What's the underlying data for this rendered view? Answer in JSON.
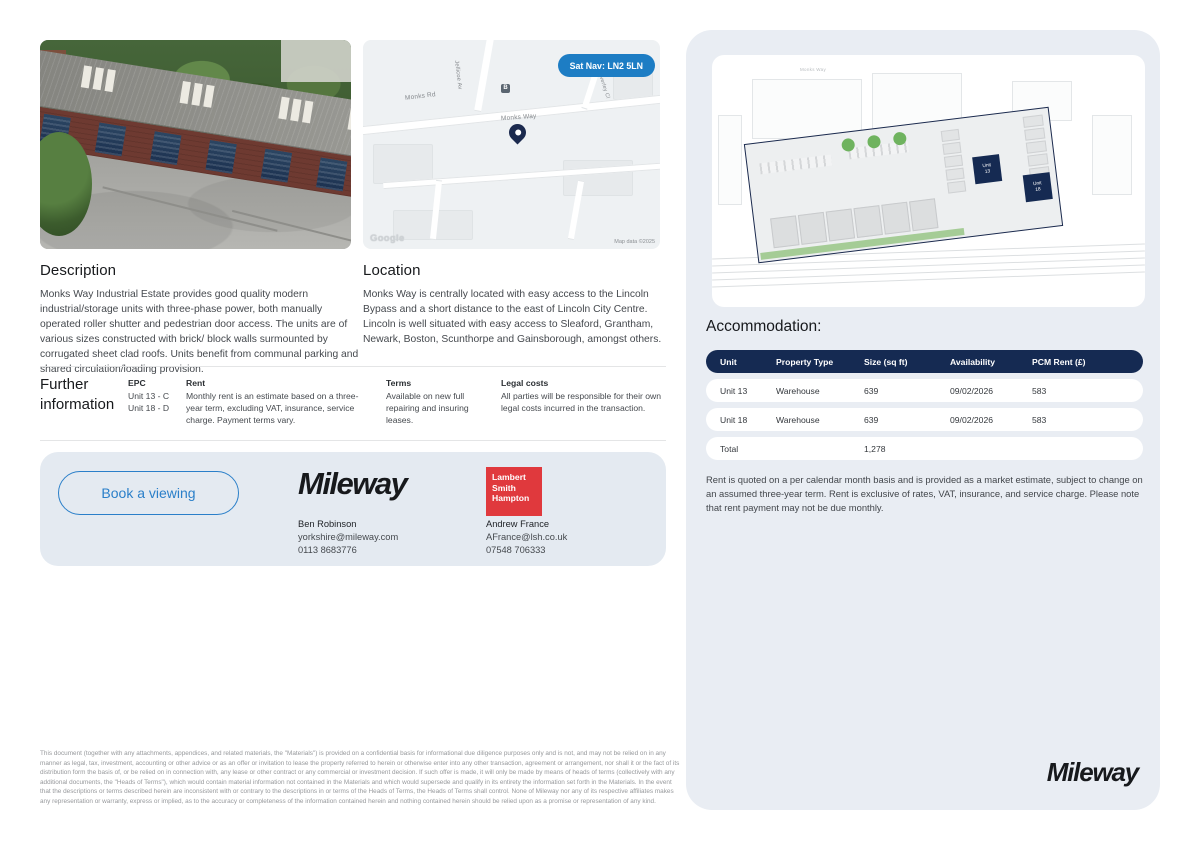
{
  "map": {
    "sat_nav": "Sat Nav: LN2 5LN",
    "roads": {
      "monks_rd": "Monks Rd",
      "monks_way": "Monks Way",
      "jellicoe": "Jellicoe Av",
      "side_close": "Waverley Cl"
    },
    "google": "Google",
    "attribution": "Map data ©2025"
  },
  "description": {
    "title": "Description",
    "body": "Monks Way Industrial Estate provides good quality modern industrial/storage units with three-phase power, both manually operated roller shutter and pedestrian door access. The units are of various sizes constructed with brick/ block walls surmounted by corrugated sheet clad roofs. Units benefit from communal parking and shared circulation/loading provision."
  },
  "location": {
    "title": "Location",
    "body": "Monks Way is centrally located with easy access to the Lincoln Bypass and a short distance to the east of Lincoln City Centre. Lincoln is well situated with easy access to Sleaford, Grantham, Newark, Boston, Scunthorpe and Gainsborough, amongst others."
  },
  "further_information": {
    "title_line1": "Further",
    "title_line2": "information",
    "epc": {
      "heading": "EPC",
      "lines": [
        "Unit 13 - C",
        "Unit 18 - D"
      ]
    },
    "rent": {
      "heading": "Rent",
      "body": "Monthly rent is an estimate based on a three-year term, excluding VAT, insurance, service charge. Payment terms vary."
    },
    "terms": {
      "heading": "Terms",
      "body": "Available on new full repairing and insuring leases."
    },
    "legal": {
      "heading": "Legal costs",
      "body": "All parties will be responsible for their own legal costs incurred in the transaction."
    }
  },
  "contact": {
    "book_button": "Book a viewing",
    "mileway_logo": "Mileway",
    "agent1": {
      "name": "Ben Robinson",
      "email": "yorkshire@mileway.com",
      "phone": "0113 8683776"
    },
    "lsh_logo": [
      "Lambert",
      "Smith",
      "Hampton"
    ],
    "agent2": {
      "name": "Andrew France",
      "email": "AFrance@lsh.co.uk",
      "phone": "07548 706333"
    }
  },
  "siteplan": {
    "road_label": "Monks Way",
    "unit13": {
      "l1": "Unit",
      "l2": "13"
    },
    "unit18": {
      "l1": "Unit",
      "l2": "18"
    }
  },
  "accommodation": {
    "title": "Accommodation:",
    "headers": [
      "Unit",
      "Property Type",
      "Size (sq ft)",
      "Availability",
      "PCM Rent (£)"
    ],
    "rows": [
      [
        "Unit 13",
        "Warehouse",
        "639",
        "09/02/2026",
        "583"
      ],
      [
        "Unit 18",
        "Warehouse",
        "639",
        "09/02/2026",
        "583"
      ],
      [
        "Total",
        "",
        "1,278",
        "",
        ""
      ]
    ],
    "note": "Rent is quoted on a per calendar month basis and is provided as a market estimate, subject to change on an assumed three-year term. Rent is exclusive of rates, VAT, insurance, and service charge. Please note that rent payment may not be due monthly."
  },
  "branding": {
    "mileway_bottom": "Mileway"
  },
  "footer": {
    "disclaimer": "This document (together with any attachments, appendices, and related materials, the \"Materials\") is provided on a confidential basis for informational due diligence purposes only and is not, and may not be relied on in any manner as legal, tax, investment, accounting or other advice or as an offer or invitation to lease the property referred to herein or otherwise enter into any other transaction, agreement or arrangement, nor shall it or the fact of its distribution form the basis of, or be relied on in connection with, any lease or other contract or any commercial or investment decision. If such offer is made, it will only be made by means of heads of terms (collectively with any additional documents, the \"Heads of Terms\"), which would contain material information not contained in the Materials and which would supersede and qualify in its entirety the information set forth in the Materials. In the event that the descriptions or terms described herein are inconsistent with or contrary to the descriptions in or terms of the Heads of Terms, the Heads of Terms shall control. None of Mileway nor any of its respective affiliates makes any representation or warranty, express or implied, as to the accuracy or completeness of the information contained herein and nothing contained herein should be relied upon as a promise or representation of any kind."
  },
  "colors": {
    "navy": "#152a52",
    "blue": "#1d7dc4",
    "panel": "#e9edf3",
    "lsh_red": "#e0393d"
  }
}
